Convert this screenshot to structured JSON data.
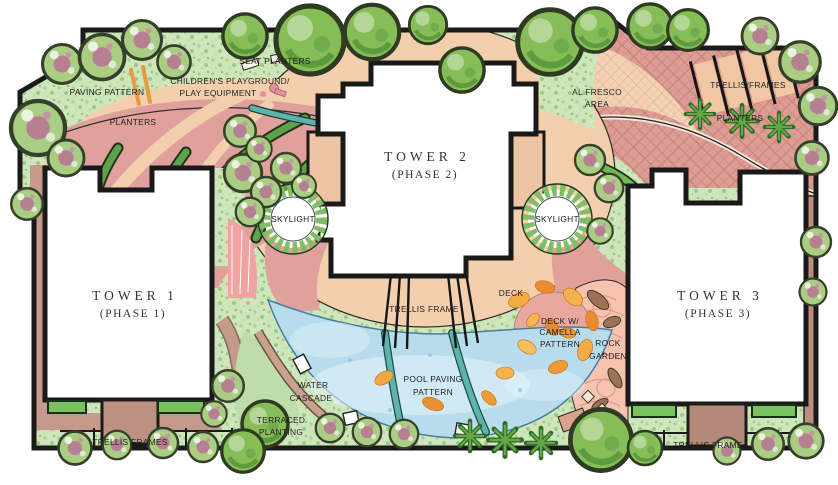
{
  "plan": {
    "type": "landscape-site-plan",
    "palette": {
      "lawn": "#cfe5bc",
      "lawn_speckle": "#9bcb85",
      "paving_peach": "#f3cfae",
      "plaza_rose": "#e0a09b",
      "crosshatch_rose": "#dd9d95",
      "crosshatch_line": "#c6837b",
      "alfresco_tile": "#f3d3b6",
      "pool_blue": "#b9dced",
      "teal_band": "#5fb3aa",
      "petal_orange": "#f5ab42",
      "rock_garden_pink": "#f5c3b0",
      "wall_mauve": "#bb8e7e",
      "tree_green": "#86bd57",
      "flower_pink": "#b77f92",
      "ink": "#1a1a1a"
    }
  },
  "labels": {
    "seat_planters": "SEAT PLANTERS",
    "childrens_playground_line1": "CHILDREN'S PLAYGROUND/",
    "childrens_playground_line2": "PLAY EQUIPMENT",
    "paving_pattern": "PAVING PATTERN",
    "planters_left": "PLANTERS",
    "tower1_line1": "TOWER 1",
    "tower1_line2": "(PHASE 1)",
    "tower2_line1": "TOWER 2",
    "tower2_line2": "(PHASE 2)",
    "tower3_line1": "TOWER 3",
    "tower3_line2": "(PHASE 3)",
    "al_fresco_line1": "AL FRESCO",
    "al_fresco_line2": "AREA",
    "trellis_frames_top": "TRELLIS/FRAMES",
    "planters_right": "PLANTERS",
    "skylight_left": "SKYLIGHT",
    "skylight_right": "SKYLIGHT",
    "deck": "DECK",
    "trellis_frame_center": "TRELLIS FRAME",
    "deck_camella_line1": "DECK W/",
    "deck_camella_line2": "CAMELLA",
    "deck_camella_line3": "PATTERN",
    "rock_garden_line1": "ROCK",
    "rock_garden_line2": "GARDEN",
    "pool_paving_line1": "POOL PAVING",
    "pool_paving_line2": "PATTERN",
    "water_cascade_line1": "WATER",
    "water_cascade_line2": "CASCADE",
    "terraced_planting_line1": "TERRACED",
    "terraced_planting_line2": "PLANTING",
    "trellis_frames_bottom_left": "TRELLIS FRAMES",
    "trellis_frame_bottom_right": "TRELLIS FRAME"
  }
}
